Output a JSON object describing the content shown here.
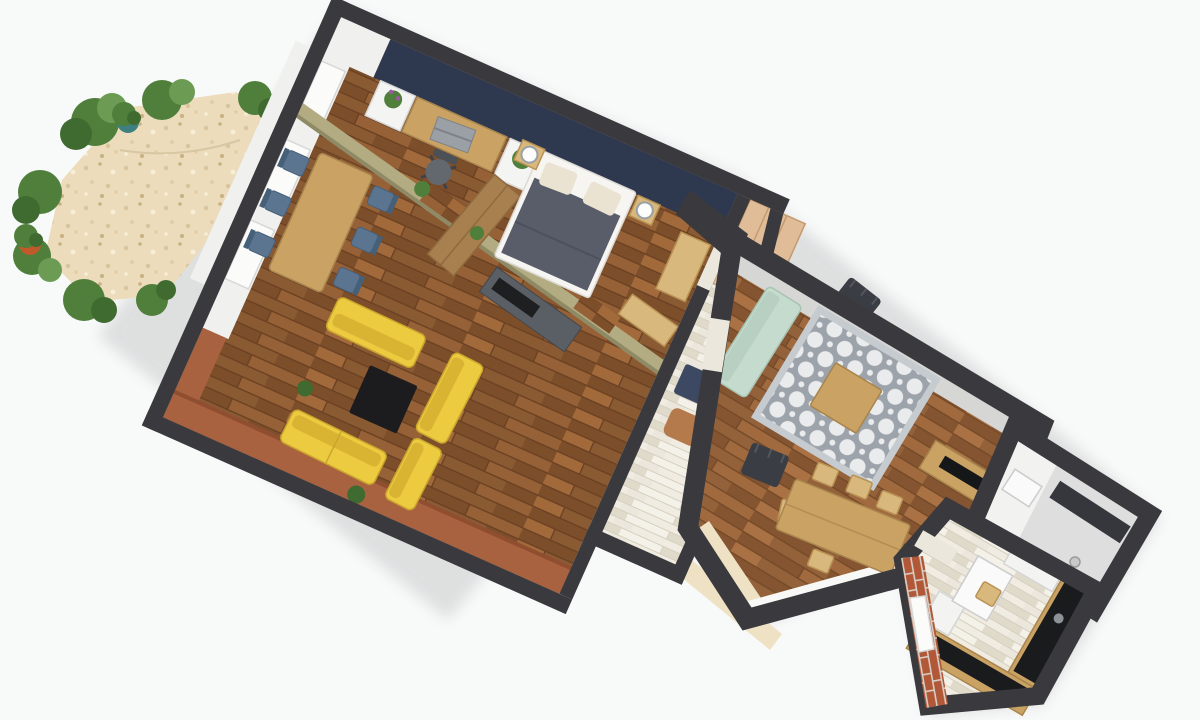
{
  "app": {
    "view": "3d-floorplan-top-view",
    "visible_text": "none"
  },
  "palette": {
    "bg": "#f8f9f9",
    "wall": "#3a3a3e",
    "navy": "#2e3950",
    "whiteface": "#f0f0ef",
    "window": "#fbfbfa",
    "windowframe": "#d8d8d8",
    "brickface": "#a9623f",
    "partition": "#b3ab82",
    "partitionEdge": "#8f8a66",
    "grayband": "#d6d6d5",
    "cream": "#efe1c4",
    "sill": "#f8f8f6",
    "wood1": "#8a5a32",
    "wood2": "#7c4e2a",
    "wood3": "#966136",
    "wood4": "#a26a3b",
    "woodSeam": "#6b4123",
    "whitewashBase": "#ebe7dc",
    "whitewash1": "#f4f1e9",
    "whitewash2": "#e0dacb",
    "whitewashSeam": "#d6cfbf",
    "gravelBase": "#ecdcbb",
    "gravelDot1": "#d9c49c",
    "gravelDot2": "#c9b183",
    "gravelDot3": "#f7eed8",
    "brick": "#b05838",
    "mortar": "#d8cdc3",
    "furnWood": "#c9a264",
    "furnWoodEdge": "#a8854d",
    "benchWood": "#d9b87e",
    "benchWoodEdge": "#b89253",
    "whitecab": "#f4f4f2",
    "wardrobe": "#a87f4e",
    "duvet": "#585d69",
    "pillow": "#eae3d2",
    "blueChair": "#5b7590",
    "sofaYellow": "#eccb40",
    "sofaYellowSeat": "#d9b432",
    "coffeeBlack": "#1c1c1f",
    "hallCloset": "#e0bd98",
    "navyBench": "#3d4963",
    "pouf": "#b57a4c",
    "mint": "#c5dbcd",
    "rugGray": "#9da3aa",
    "rugWhite": "#e9ebed",
    "rugBorder": "#c6cbd0",
    "plantGreen": "#4f7f3b",
    "plantDark": "#3f6b31",
    "flower": "#9b59a8",
    "potTerracotta": "#c05a2a",
    "potTeal": "#3e7f80"
  },
  "scene": {
    "rooms": [
      {
        "id": "bedroom-office",
        "floor": "dark-oak-parquet",
        "accent_wall": "navy-blue",
        "furniture": [
          "desk",
          "laptop",
          "office-chair",
          "white-cabinet-with-plant",
          "white-cabinet-with-plant-2",
          "tall-wardrobe",
          "double-bed-gray-duvet",
          "nightstand-left",
          "nightstand-right",
          "glass-ball-lamp-left",
          "glass-ball-lamp-right",
          "bench"
        ]
      },
      {
        "id": "living-dining-room",
        "floor": "dark-oak-parquet",
        "accent_wall": "brick-terracotta",
        "furniture": [
          "dining-table",
          "blue-chair x6",
          "dark-kitchen-counter",
          "yellow-sofa x4",
          "black-coffee-table",
          "floor-plant x4"
        ]
      },
      {
        "id": "hallway",
        "floor": "whitewashed-planks",
        "furniture": [
          "closet-wardrobe",
          "navy-cabinet",
          "navy-bench",
          "leather-pouf"
        ]
      },
      {
        "id": "second-living-room",
        "floor": "oak-parquet",
        "accent_wall": "light-gray",
        "furniture": [
          "mint-sofa",
          "gray-quatrefoil-rug",
          "wood-coffee-table",
          "black-armchair x2",
          "dining-table-with-5-chairs",
          "tv-sideboard",
          "plant"
        ]
      },
      {
        "id": "bathroom",
        "floor": "white-tile",
        "furniture": [
          "walk-in-shower-dark-glass",
          "vanity",
          "floor-drain"
        ]
      },
      {
        "id": "kitchen",
        "floor": "whitewashed-planks",
        "accent_wall": "red-brick-with-window",
        "furniture": [
          "l-shaped-counter-black-top",
          "sink",
          "fridge",
          "upper-cabinet",
          "small-white-table",
          "wood-chair"
        ]
      }
    ],
    "garden": {
      "ground": "gravel-patio",
      "items": [
        "bush x9",
        "terracotta-potted-plant",
        "teal-potted-plant"
      ]
    }
  }
}
